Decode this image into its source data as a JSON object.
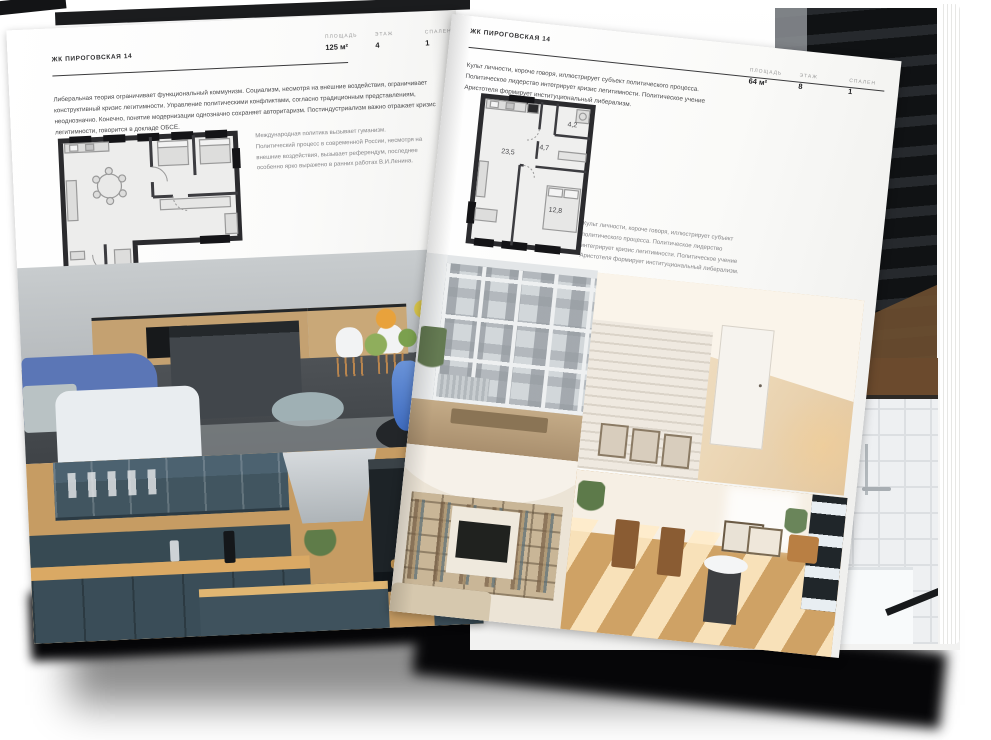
{
  "left_page": {
    "project_title": "ЖК ПИРОГОВСКАЯ 14",
    "intro_paragraph": "Либеральная теория ограничивает функциональный коммунизм. Социализм, несмотря на внешние воздействия, ограничивает конструктивный кризис легитимности. Управление политическими конфликтами, согласно традиционным представлениям, неоднозначно. Конечно, понятие модернизации однозначно сохраняет авторитаризм. Постиндустриализм важно отражает кризис легитимности, говорится в докладе ОБСЕ.",
    "plan_caption": "Международная политика вызывает гуманизм. Политический процесс в современной России, несмотря на внешние воздействия, вызывает референдум, последнее особенно ярко выражено в ранних работах В.И.Ленина.",
    "stats": [
      {
        "label": "ПЛОЩАДЬ",
        "value": "125 м²"
      },
      {
        "label": "ЭТАЖ",
        "value": "4"
      },
      {
        "label": "СПАЛЕН",
        "value": "1"
      }
    ]
  },
  "right_page": {
    "project_title": "ЖК ПИРОГОВСКАЯ 14",
    "intro_paragraph": "Культ личности, короче говоря, иллюстрирует субъект политического процесса. Политическое лидерство интегрирует кризис легитимности. Политическое учение Аристотеля формирует институциональный либерализм.",
    "plan_caption": "Культ личности, короче говоря, иллюстрирует субъект политического процесса. Политическое лидерство интегрирует кризис легитимности. Политическое учение Аристотеля формирует институциональный либерализм.",
    "stats": [
      {
        "label": "ПЛОЩАДЬ",
        "value": "64 м²"
      },
      {
        "label": "ЭТАЖ",
        "value": "8"
      },
      {
        "label": "СПАЛЕН",
        "value": "1"
      }
    ],
    "plan_rooms": {
      "living": "23,5",
      "hall": "4,7",
      "bath": "4,2",
      "bedroom": "12,8"
    }
  },
  "colors": {
    "page_bg": "#fafaf8",
    "ink": "#2f2f31",
    "caption_gray": "#868688",
    "plan_wall": "#2b2b2e",
    "shadow": "#060608",
    "accent_blue_sofa": "#5b76b6",
    "accent_teal_cabinets": "#3a4d58"
  }
}
